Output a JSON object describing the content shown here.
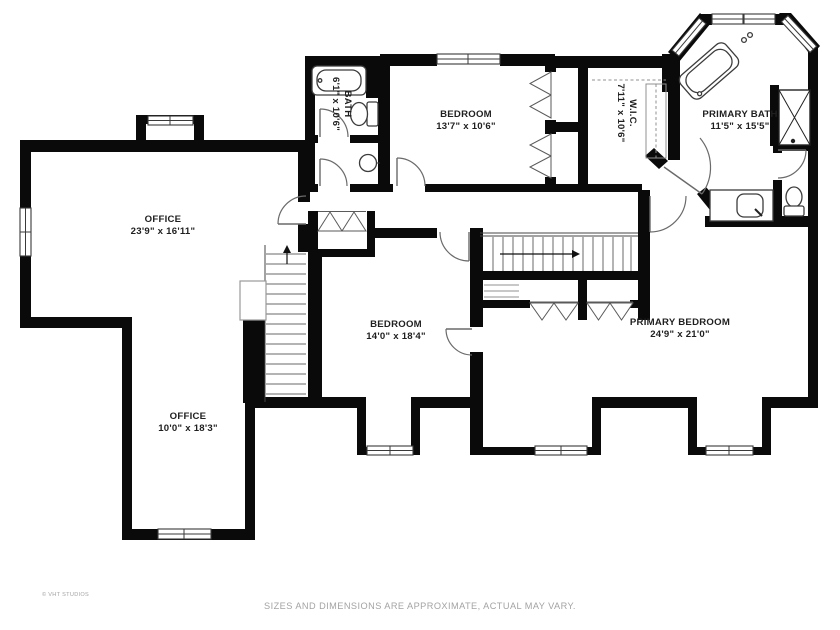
{
  "colors": {
    "wall": "#0a0a0a",
    "background": "#ffffff",
    "fixture": "#3c3c3c",
    "door": "#6a6a6a",
    "label": "#1f1f1f",
    "muted": "#a3a3a3"
  },
  "rooms": [
    {
      "id": "office-upper",
      "name": "OFFICE",
      "dims": "23'9\" x 16'11\"",
      "x": 163,
      "y": 222,
      "rotated": false
    },
    {
      "id": "office-lower",
      "name": "OFFICE",
      "dims": "10'0\" x 18'3\"",
      "x": 188,
      "y": 419,
      "rotated": false
    },
    {
      "id": "bath",
      "name": "BATH",
      "dims": "6'1\" x 10'6\"",
      "x": 345,
      "y": 104,
      "rotated": true
    },
    {
      "id": "bedroom-top",
      "name": "BEDROOM",
      "dims": "13'7\" x 10'6\"",
      "x": 466,
      "y": 117,
      "rotated": false
    },
    {
      "id": "walk-in-closet",
      "name": "W.I.C.",
      "dims": "7'11\" x 10'6\"",
      "x": 630,
      "y": 113,
      "rotated": true
    },
    {
      "id": "primary-bath",
      "name": "PRIMARY BATH",
      "dims": "11'5\" x 15'5\"",
      "x": 740,
      "y": 117,
      "rotated": false
    },
    {
      "id": "bedroom-middle",
      "name": "BEDROOM",
      "dims": "14'0\" x 18'4\"",
      "x": 396,
      "y": 327,
      "rotated": false
    },
    {
      "id": "primary-bedroom",
      "name": "PRIMARY BEDROOM",
      "dims": "24'9\" x 21'0\"",
      "x": 680,
      "y": 325,
      "rotated": false
    }
  ],
  "footer": {
    "copyright": "© VHT STUDIOS",
    "disclaimer": "SIZES AND DIMENSIONS ARE APPROXIMATE, ACTUAL MAY VARY."
  }
}
